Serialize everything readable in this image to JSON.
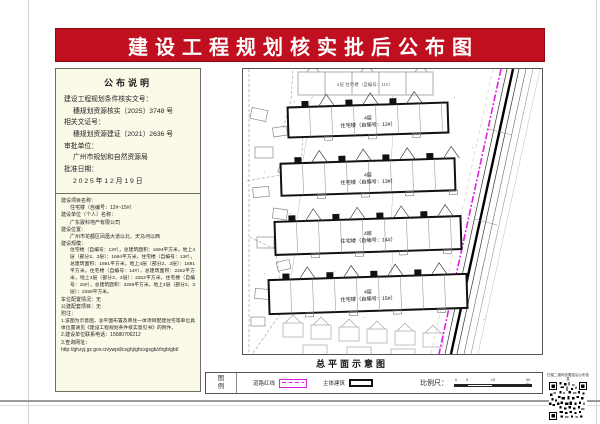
{
  "title": "建设工程规划核实批后公布图",
  "notice": {
    "header": "公布说明",
    "lines": [
      "建设工程规划条件核实文号：",
      "穗规划资源核实〔2025〕3748 号",
      "相关文证号：",
      "穗规划资源建证〔2021〕2636 号",
      "审批单位：",
      "广州市规划和自然资源局",
      "批准日期：",
      "2 0 2 5 年 1 2 月 1 9 日"
    ]
  },
  "project": {
    "lines": [
      "建设项目名称：",
      "住宅楼（自编号：12#~15#）",
      "建设单位（个人）名称：",
      "广东骏科地产有限公司",
      "建设位置：",
      "广州市花都区凤凰大道以北、天马河以西",
      "建设规模：",
      "住宅楼（自编号：12#），总建筑面积：1694平方米，地上4层（部分2、3层）：1694平方米，住宅楼（自编号：13#），总建筑面积：1691平方米，地上4层（部分2、3层）：1691平方米，住宅楼（自编号：14#），总建筑面积：2252平方米，地上4层（部分2、3层）：2252平方米，住宅楼（自编号：15#），总建筑面积：2259平方米，地上4层（部分2、3层）：2259平方米。",
      "车位配置情况：无",
      "公建配套项目：无",
      "附注：",
      "1.该图为示意图，总平面布置及商住一体项目配建住宅等单位具体位置请见《建设工程规划条件核实意见书》的附件。",
      "2.建设单位联系电话：15680706212",
      "3.查询网址：",
      "http://ghzyj.gz.gov.cn/ywpd/csghj/ghcsgsgb/zhgb/gbt/"
    ]
  },
  "drawing": {
    "caption": "总平面示意图",
    "context_building_label": "4层 住宅楼（自编号：11#）",
    "buildings": [
      {
        "floors": "4层",
        "name": "住宅楼（自编号：12#）"
      },
      {
        "floors": "4层",
        "name": "住宅楼（自编号：13#）"
      },
      {
        "floors": "4层",
        "name": "住宅楼（自编号：14#）"
      },
      {
        "floors": "4层",
        "name": "住宅楼（自编号：15#）"
      }
    ]
  },
  "legend": {
    "title_chars": [
      "图",
      "例"
    ],
    "items": [
      {
        "label": "道路红线",
        "symbol": "magenta-dashed-line"
      },
      {
        "label": "主体建筑",
        "symbol": "building-outline-rect"
      }
    ],
    "scale_label": "比例尺：",
    "scale_ticks": [
      "0",
      "5",
      "15",
      "30米"
    ]
  },
  "qr": {
    "caption": "扫描二维码查看批后公布信息"
  },
  "colors": {
    "banner_red": "#c00f1f",
    "panel_cream": "#fbfae9",
    "road_magenta": "#e31ee3"
  }
}
